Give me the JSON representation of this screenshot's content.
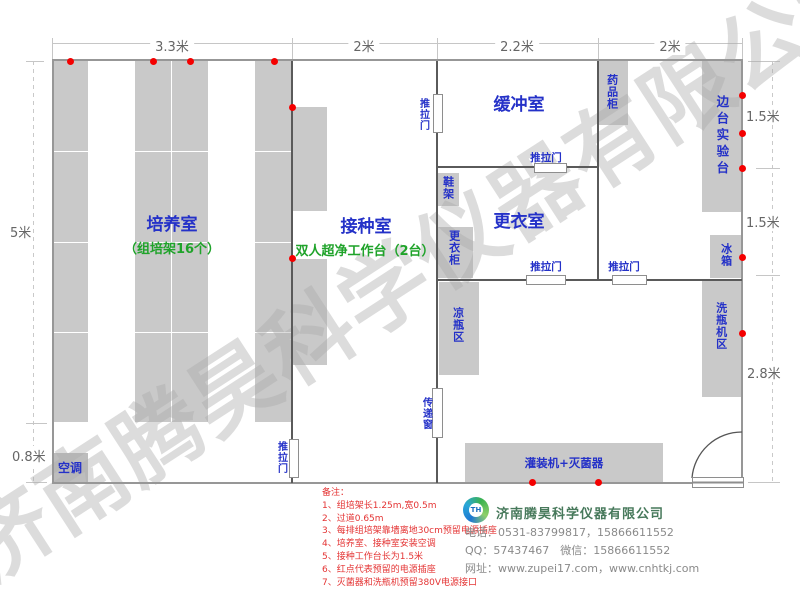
{
  "plan": {
    "dims_top": [
      "3.3米",
      "2米",
      "2.2米",
      "2米"
    ],
    "dim_left_main": "5米",
    "dim_left_bottom": "0.8米",
    "dims_right": [
      "1.5米",
      "1.5米",
      "2.8米"
    ],
    "rooms": {
      "cultivation_title": "培养室",
      "cultivation_sub": "（组培架16个）",
      "inoculation_title": "接种室",
      "inoculation_sub": "双人超净工作台（2台）",
      "buffer_title": "缓冲室",
      "changing_title": "更衣室"
    },
    "fixtures": {
      "sliding_door": "推拉门",
      "shoe_rack": "鞋架",
      "wardrobe": "更衣柜",
      "medicine_cabinet": "药品柜",
      "side_bench": "边台实验台",
      "fridge": "冰箱",
      "washer_area": "洗瓶机区",
      "cooling_area": "凉瓶区",
      "pass_window": "传递窗",
      "filling_sterilizer": "灌装机+灭菌器",
      "air_conditioner": "空调"
    }
  },
  "notes": {
    "header": "备注：",
    "items": [
      "1、组培架长1.25m,宽0.5m",
      "2、过道0.65m",
      "3、每排组培架靠墙离地30cm预留电源插座",
      "4、培养室、接种室安装空调",
      "5、接种工作台长为1.5米",
      "6、红点代表预留的电源插座",
      "7、灭菌器和洗瓶机预留380V电源接口"
    ]
  },
  "company": {
    "logo_initials": "TH",
    "name": "济南腾昊科学仪器有限公司",
    "phone": "电话：0531-83799817，15866611552",
    "qq_wechat": "QQ：57437467　微信：15866611552",
    "website": "网址：www.zupei17.com，www.cnhtkj.com"
  },
  "watermark": "济南腾昊科学仪器有限公司"
}
